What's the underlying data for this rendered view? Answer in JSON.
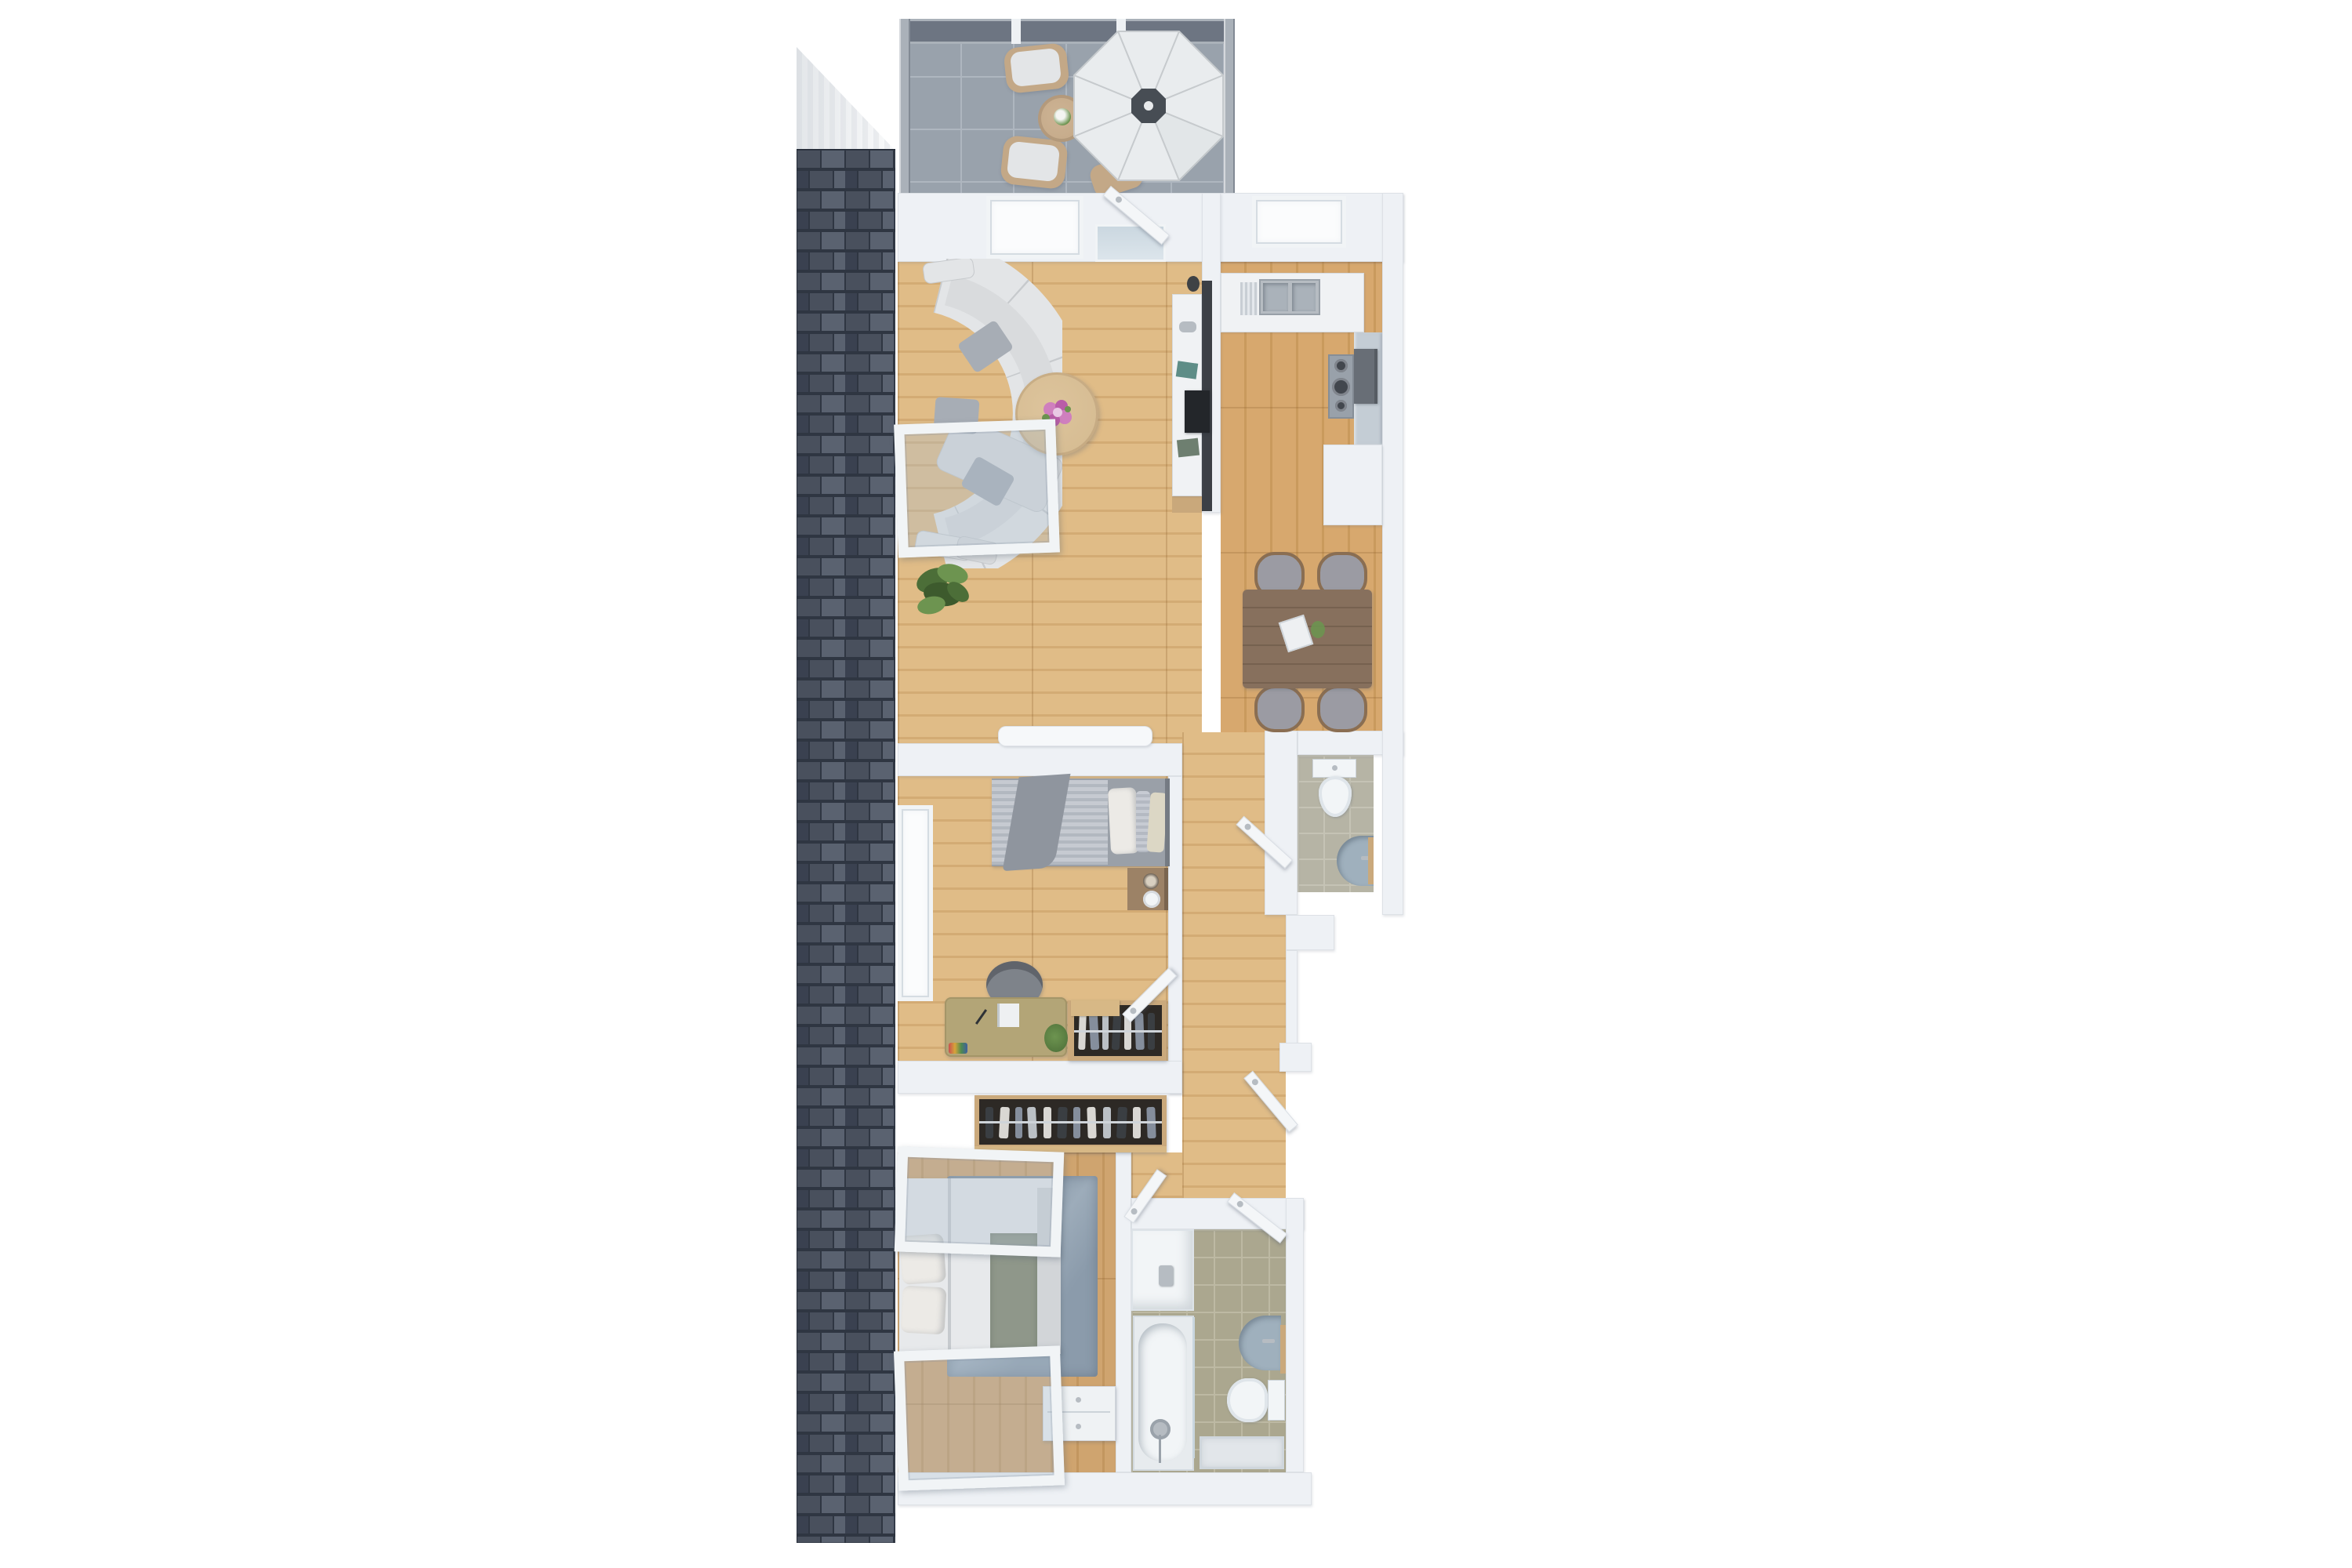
{
  "scene": {
    "kind": "3d-floor-plan-top-down-render",
    "background": "#ffffff"
  },
  "colors": {
    "wall": "#eef1f5",
    "wall_bright": "#f6f8fa",
    "recess": "#fbfcfd",
    "frame_white": "#f1f4f6",
    "frame_line": "#d5dce2",
    "window_glass": "rgba(176,193,207,0.35)",
    "door": "#f4f6f8",
    "door_edge": "#d9dee4",
    "glass": "#c9d6df",
    "brick": "#49505d",
    "brick_light": "#5a6270",
    "brick_dark": "#3a4150",
    "mortar": "#2f3642",
    "balcony_tile": "#99a2ac",
    "balcony_grout": "#aeb6bf",
    "rail_glass": "#6d7582",
    "rail_metal": "#aab1b9",
    "rail_post": "#eef1f4",
    "umbrella": "#e9ecee",
    "umbrella_seam": "#c6cacd",
    "umbrella_hub": "#474d54",
    "outdoor_wood": "#c3a887",
    "wood_living": "#e0bc87",
    "wood_living_dark": "#d3ab74",
    "wood_kitchen": "#d7a86e",
    "wood_kitchen_dark": "#c99a5d",
    "wood_master": "#cfa46f",
    "wood_master_dark": "#c2965f",
    "wood_joint": "rgba(140,95,45,0.25)",
    "marble": "#f0f2f4",
    "marble_vein": "#dcе0e5",
    "counter": "#c4cdd5",
    "hob": "#99a1aa",
    "burner": "#42474e",
    "appliance": "#686e76",
    "island_media": "#3c4046",
    "tv": "#23262a",
    "island_base": "#c9a87b",
    "sofa": "#e3e5e7",
    "sofa_line": "#c7cacd",
    "sofa_cushion": "#d9dbdd",
    "pillow": "#a7adb5",
    "coffee_table": "#d4ba90",
    "flower_pink": "#cf7fbe",
    "flower_deep": "#b95da8",
    "plant_green": "#4c6e38",
    "plant_light": "#6d9450",
    "dining_table": "#87705d",
    "dining_grain": "#76614f",
    "chair_seat": "#9b9ba3",
    "chair_wood": "#8a6e52",
    "bed_mattress": "#c6cad1",
    "bed_stripe": "#b2b8c0",
    "bed_drape": "#8f959e",
    "bed_platform": "#9aa0a8",
    "pillow_white": "#eceae6",
    "pillow_tan": "#dcd7c5",
    "headboard": "#757b83",
    "nightstand": "#9c8266",
    "desk": "#b3a577",
    "chair_dark": "#7e838a",
    "wardrobe_wood": "#caa97c",
    "wardrobe_dark": "#2d2925",
    "rail_chrome": "#cfd4d9",
    "clothes_a": "#e8e6e2",
    "clothes_b": "#8d97a6",
    "clothes_c": "#3c4044",
    "clothes_d": "#c8cdd2",
    "duvet": "#e7e9eb",
    "sage": "#8f978a",
    "foot_gray": "#d2d5d8",
    "rug": "#8b9bab",
    "rug_light": "#9dacba",
    "bench": "#eff2f4",
    "tile_wc": "#b6b4a5",
    "tile_wc_grout": "#c5c3b5",
    "tile_bath": "#aba78f",
    "tile_bath_grout": "#bdb9a3",
    "fixture": "#f2f5f7",
    "basin": "#9fb0bd",
    "chrome": "#b6bcc2"
  },
  "rooms": {
    "balcony": {
      "items": [
        "glass-balustrade",
        "tile-floor",
        "parasol",
        "round-outdoor-table",
        "flower-centerpiece",
        "outdoor-chair",
        "outdoor-chair",
        "outdoor-chair"
      ]
    },
    "living_room": {
      "items": [
        "curved-sectional-sofa",
        "throw-pillows",
        "ottoman",
        "round-coffee-table",
        "flower-bouquet",
        "floor-plant",
        "media-wall-tv",
        "marble-island-counter",
        "sideboard",
        "window",
        "open-balcony-door"
      ]
    },
    "kitchen": {
      "items": [
        "marble-counter",
        "double-sink",
        "drainer",
        "gas-hob",
        "oven-appliance",
        "window",
        "tall-cabinet-block"
      ]
    },
    "dining_area": {
      "items": [
        "rectangular-wood-table",
        "open-book",
        "plant-sprig",
        "chair",
        "chair",
        "chair",
        "chair"
      ]
    },
    "hallway": {
      "items": [
        "open-door",
        "open-door",
        "open-door"
      ]
    },
    "wc": {
      "items": [
        "tile-floor",
        "wall-hung-toilet",
        "wall-basin",
        "wood-shelf",
        "open-door"
      ]
    },
    "bedroom": {
      "items": [
        "single-bed",
        "striped-duvet",
        "draped-blanket",
        "pillows",
        "nightstand",
        "vase",
        "table-lamp",
        "desk",
        "notebook",
        "desk-chair",
        "small-plant",
        "open-wardrobe",
        "window-strip"
      ]
    },
    "master_bedroom": {
      "items": [
        "double-bed",
        "pillows",
        "sage-runner",
        "area-rug",
        "storage-bench",
        "open-closet",
        "tilted-window",
        "tilted-window"
      ]
    },
    "bathroom": {
      "items": [
        "vanity-counter",
        "faucet",
        "bathtub",
        "hand-shower",
        "glass-screen",
        "wall-basin",
        "wood-shelf",
        "toilet",
        "shower-tray",
        "open-door",
        "tile-floor"
      ]
    }
  }
}
